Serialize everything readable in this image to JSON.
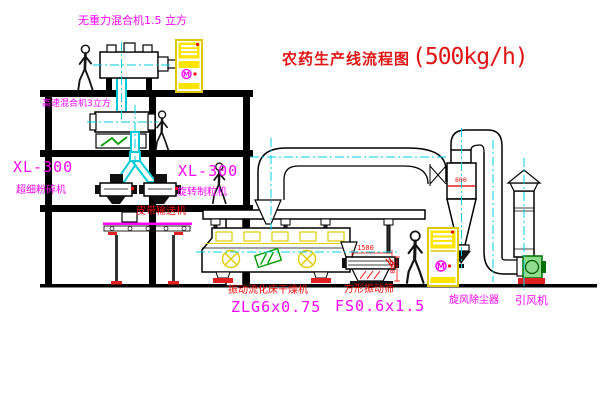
{
  "title": {
    "name": "农药生产线流程图",
    "capacity": "(500kg/h)"
  },
  "equipment_labels": {
    "gravity_free_mixer": "无重力混合机1.5 立方",
    "high_speed_mixer": "高速混合机3立方",
    "xl300_left_model": "XL-300",
    "ultrafine_mill": "超细粉碎机",
    "xl300_mid_model": "XL-300",
    "rotary_granulator": "旋转制粒机",
    "belt_conveyor": "皮带输送机",
    "fluid_bed_dryer": "振动流化床干燥机",
    "fluid_bed_dryer_model": "ZLG6x0.75",
    "square_vibrating_sieve": "方形振动筛",
    "square_vibrating_sieve_model": "FS0.6x1.5",
    "cyclone_dust_collector": "旋风除尘器",
    "induced_draft_fan": "引风机"
  },
  "dimensions": {
    "sieve_length": "1500",
    "sieve_height": "540",
    "cyclone_marking": "800"
  },
  "cabinets": {
    "symbol": "M"
  },
  "colors": {
    "background": "#ffffff",
    "line_black": "#000000",
    "label_magenta": "#ff00ff",
    "label_red": "#f00a0a",
    "title_red": "#e01414",
    "cad_yellow": "#ffe400",
    "cad_cyan": "#00ccd8",
    "cad_green": "#00a000"
  }
}
